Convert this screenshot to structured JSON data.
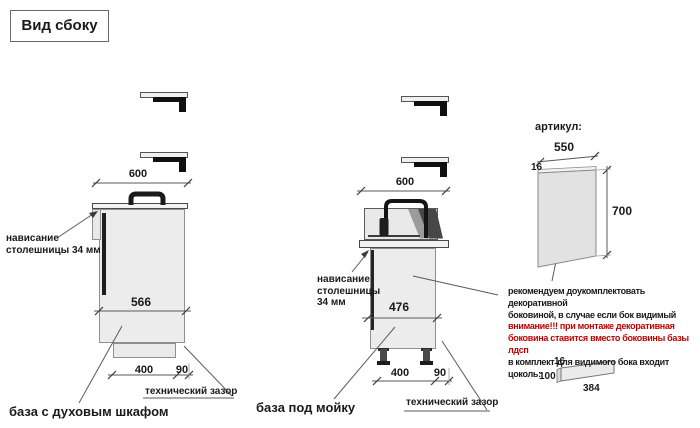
{
  "title": "Вид сбоку",
  "colors": {
    "attention_text": "#c00000",
    "body_text": "#1a1a1a",
    "drawing_line": "#5a5a5a",
    "cabinet_fill": "#ececec",
    "dark_detail": "#1a1a1a"
  },
  "left_unit": {
    "caption": "база с духовым шкафом",
    "overhang_lines": [
      "нависание",
      "столешницы 34 мм"
    ],
    "tech_gap_label": "технический зазор",
    "dim_top_width": "600",
    "dim_body": "566",
    "dim_plinth_depth": "400",
    "dim_gap": "90"
  },
  "middle_unit": {
    "caption": "база под мойку",
    "overhang_lines": [
      "нависание",
      "столешницы",
      "34 мм"
    ],
    "tech_gap_label": "технический зазор",
    "dim_top_width": "600",
    "dim_body": "476",
    "dim_plinth_depth": "400",
    "dim_gap": "90"
  },
  "side_panel": {
    "heading": "артикул:",
    "dim_width": "550",
    "dim_thickness": "16",
    "dim_height": "700",
    "note_lines": [
      {
        "text": "рекомендуем доукомплектовать декоративной",
        "emphasis": false
      },
      {
        "text": "боковиной, в случае если бок видимый",
        "emphasis": false
      },
      {
        "text": "внимание!!! при монтаже декоративная",
        "emphasis": true
      },
      {
        "text": "боковина ставится вместо боковины базы лдсп",
        "emphasis": true
      },
      {
        "text": "в комплект для видимого бока входит цоколь:",
        "emphasis": false
      }
    ],
    "plinth": {
      "dim_thickness": "16",
      "dim_height": "100",
      "dim_length": "384"
    }
  }
}
